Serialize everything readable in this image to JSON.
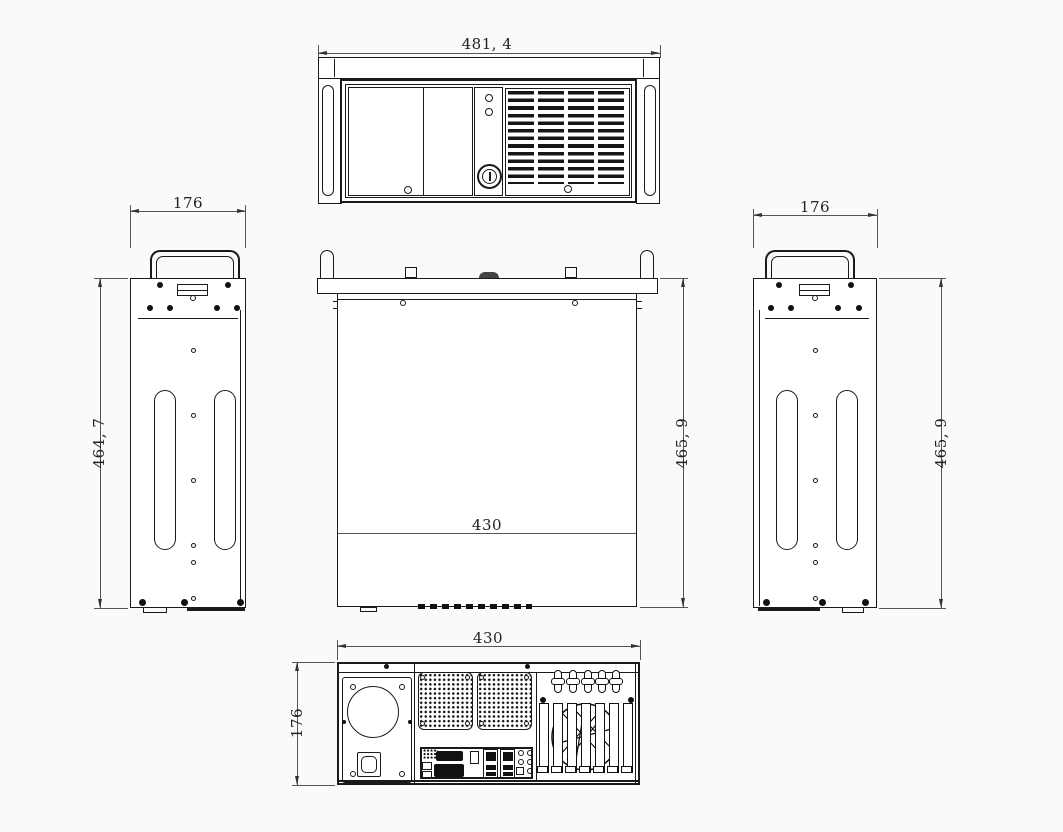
{
  "dimensions": {
    "front_width": "481, 4",
    "left_view_width": "176",
    "left_view_height": "464, 7",
    "top_view_inner_width": "430",
    "top_view_depth": "465, 9",
    "right_view_width": "176",
    "right_view_height": "465, 9",
    "rear_width": "430",
    "rear_height": "176"
  },
  "colors": {
    "line": "#1a1a1a",
    "dimension_line": "#555555",
    "background": "#fafafa",
    "fill": "#111111"
  }
}
